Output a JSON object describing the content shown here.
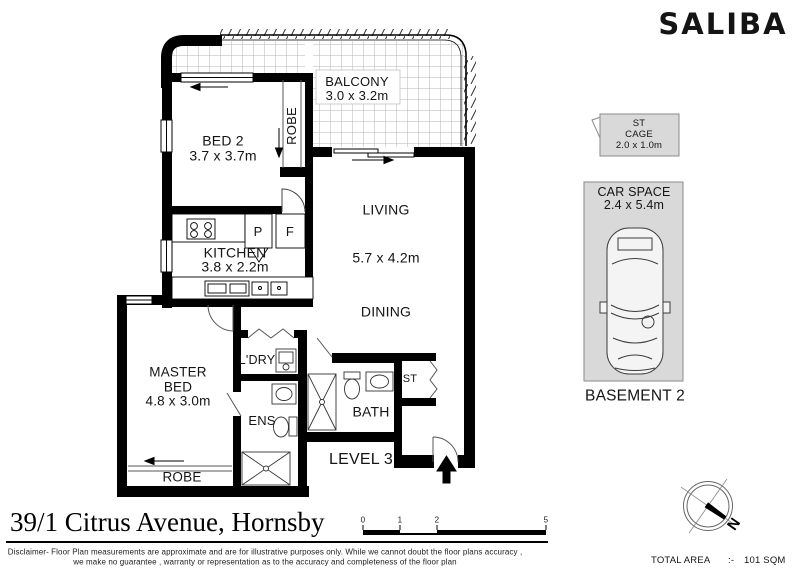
{
  "logo": {
    "text": "SALIBA"
  },
  "floor_plan": {
    "rooms": {
      "balcony": {
        "name": "BALCONY",
        "size": "3.0 x 3.2m"
      },
      "bed2": {
        "name": "BED 2",
        "size": "3.7 x 3.7m"
      },
      "robe_bed2": "ROBE",
      "kitchen": {
        "name": "KITCHEN",
        "size": "3.8 x 2.2m"
      },
      "living": "LIVING",
      "living_dining_size": "5.7 x 4.2m",
      "dining": "DINING",
      "master_bed": {
        "line1": "MASTER",
        "line2": "BED",
        "size": "4.8 x 3.0m"
      },
      "laundry": "L'DRY",
      "ensuite": "ENS",
      "bath": "BATH",
      "storage": "ST",
      "robe_master": "ROBE",
      "pantry": "P",
      "fridge": "F"
    },
    "level": "LEVEL 3"
  },
  "side_panel": {
    "storage_cage": {
      "line1": "ST",
      "line2": "CAGE",
      "size": "2.0 x 1.0m"
    },
    "car_space": {
      "name": "CAR SPACE",
      "size": "2.4 x 5.4m"
    },
    "basement": "BASEMENT 2",
    "compass_north": "N",
    "total_area_label": "TOTAL AREA",
    "total_area_separator": ":-",
    "total_area_value": "101 SQM"
  },
  "footer": {
    "address": "39/1 Citrus Avenue, Hornsby",
    "scale_labels": [
      "0",
      "1",
      "2",
      "5"
    ],
    "disclaimer_line1": "Disclaimer- Floor Plan measurements are approximate and are for illustrative purposes only. While we cannot doubt the floor plans accuracy ,",
    "disclaimer_line2": "we make no guarantee , warranty or representation as to the accuracy and completeness of the floor plan"
  },
  "colors": {
    "wall": "#000000",
    "box_fill": "#d9d9d9",
    "box_border": "#8a8a8a",
    "tile_grid": "#b5b5b5"
  }
}
